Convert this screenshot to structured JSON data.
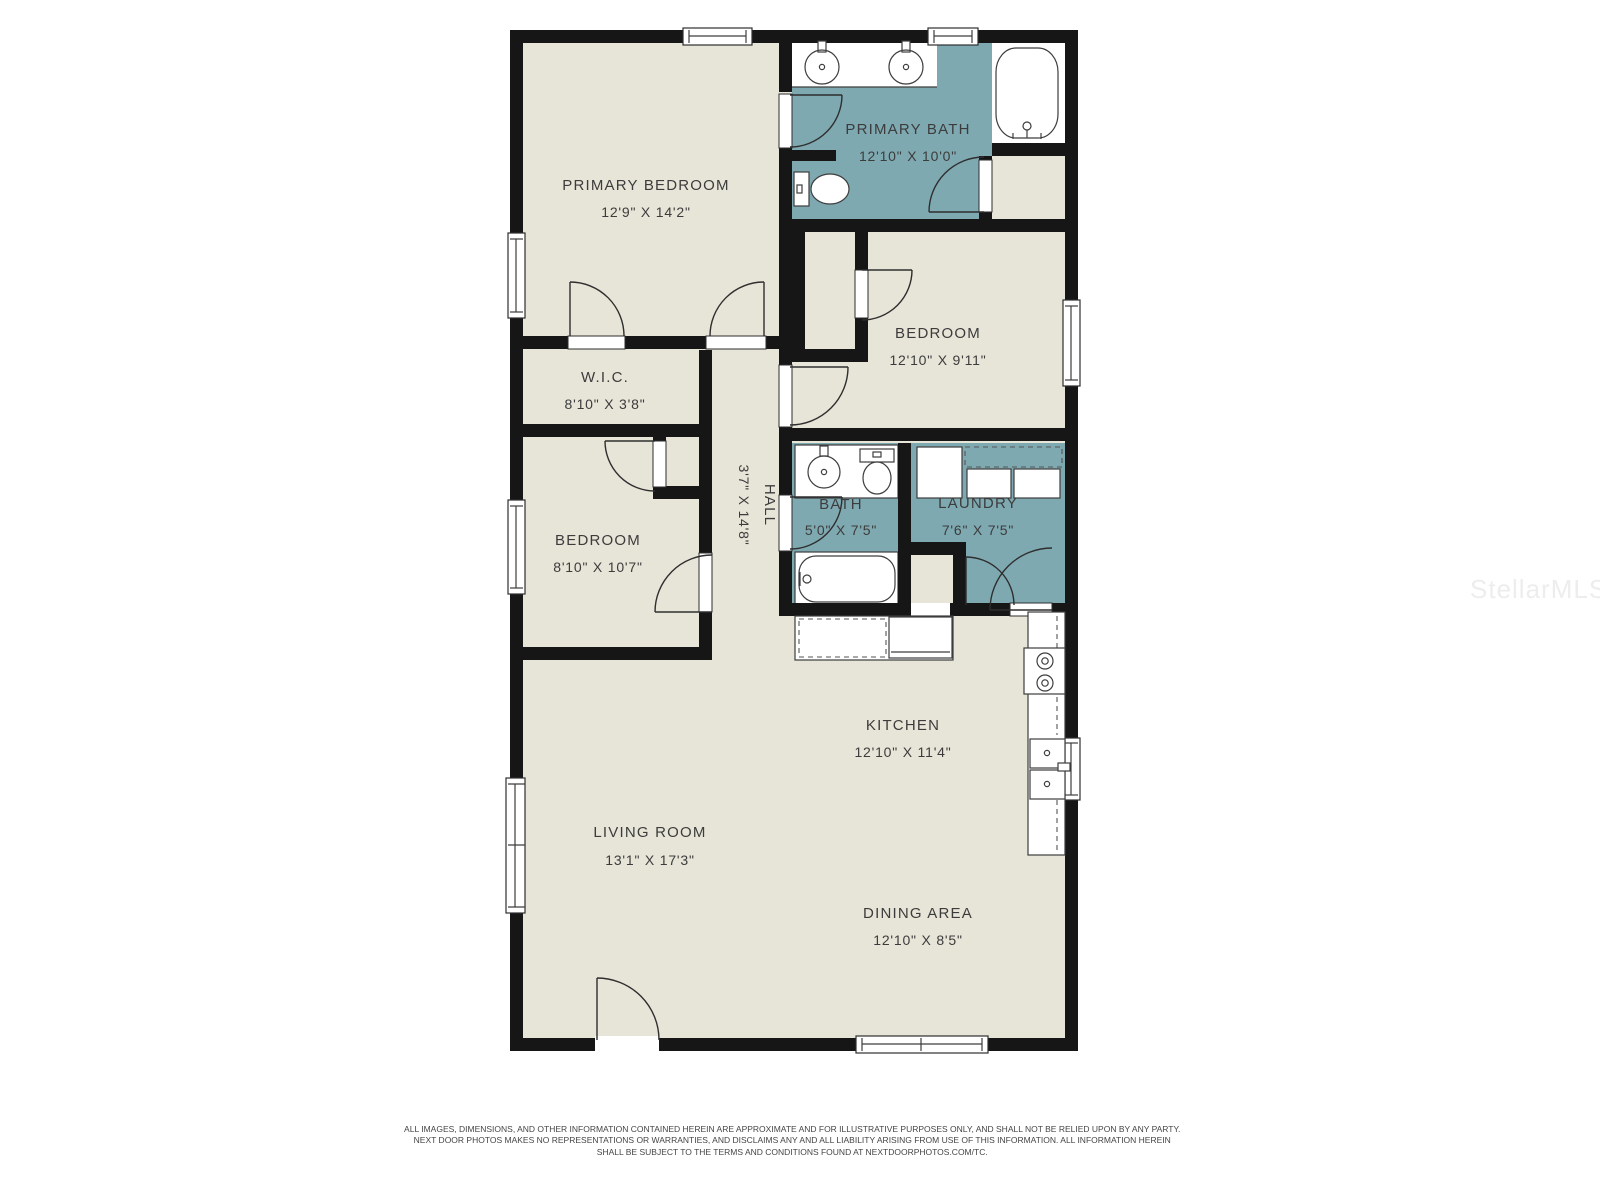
{
  "colors": {
    "floor": "#e7e4d8",
    "wet": "#7fa9b1",
    "wall": "#161616",
    "line": "#3d3d3d",
    "label": "#3c3c3c",
    "watermark": "#ededed",
    "disclaimer": "#454545"
  },
  "watermark": "StellarMLS",
  "rooms": {
    "primary_bedroom": {
      "name": "PRIMARY BEDROOM",
      "dims": "12'9\" X 14'2\""
    },
    "primary_bath": {
      "name": "PRIMARY BATH",
      "dims": "12'10\" X 10'0\""
    },
    "bedroom_ne": {
      "name": "BEDROOM",
      "dims": "12'10\" X 9'11\""
    },
    "wic": {
      "name": "W.I.C.",
      "dims": "8'10\" X 3'8\""
    },
    "bedroom_mid": {
      "name": "BEDROOM",
      "dims": "8'10\" X 10'7\""
    },
    "hall": {
      "name": "HALL",
      "dims": "3'7\" X 14'8\""
    },
    "bath": {
      "name": "BATH",
      "dims": "5'0\" X 7'5\""
    },
    "laundry": {
      "name": "LAUNDRY",
      "dims": "7'6\" X 7'5\""
    },
    "kitchen": {
      "name": "KITCHEN",
      "dims": "12'10\" X 11'4\""
    },
    "living_room": {
      "name": "LIVING ROOM",
      "dims": "13'1\" X 17'3\""
    },
    "dining_area": {
      "name": "DINING AREA",
      "dims": "12'10\" X 8'5\""
    }
  },
  "disclaimer": {
    "line1": "ALL IMAGES, DIMENSIONS, AND OTHER INFORMATION CONTAINED HEREIN ARE APPROXIMATE AND FOR ILLUSTRATIVE PURPOSES ONLY, AND SHALL NOT BE RELIED UPON BY ANY PARTY.",
    "line2": "NEXT DOOR PHOTOS MAKES NO REPRESENTATIONS OR WARRANTIES, AND DISCLAIMS ANY AND ALL LIABILITY ARISING FROM USE OF THIS INFORMATION. ALL INFORMATION HEREIN",
    "line3": "SHALL BE SUBJECT TO THE TERMS AND CONDITIONS FOUND AT NEXTDOORPHOTOS.COM/TC."
  }
}
